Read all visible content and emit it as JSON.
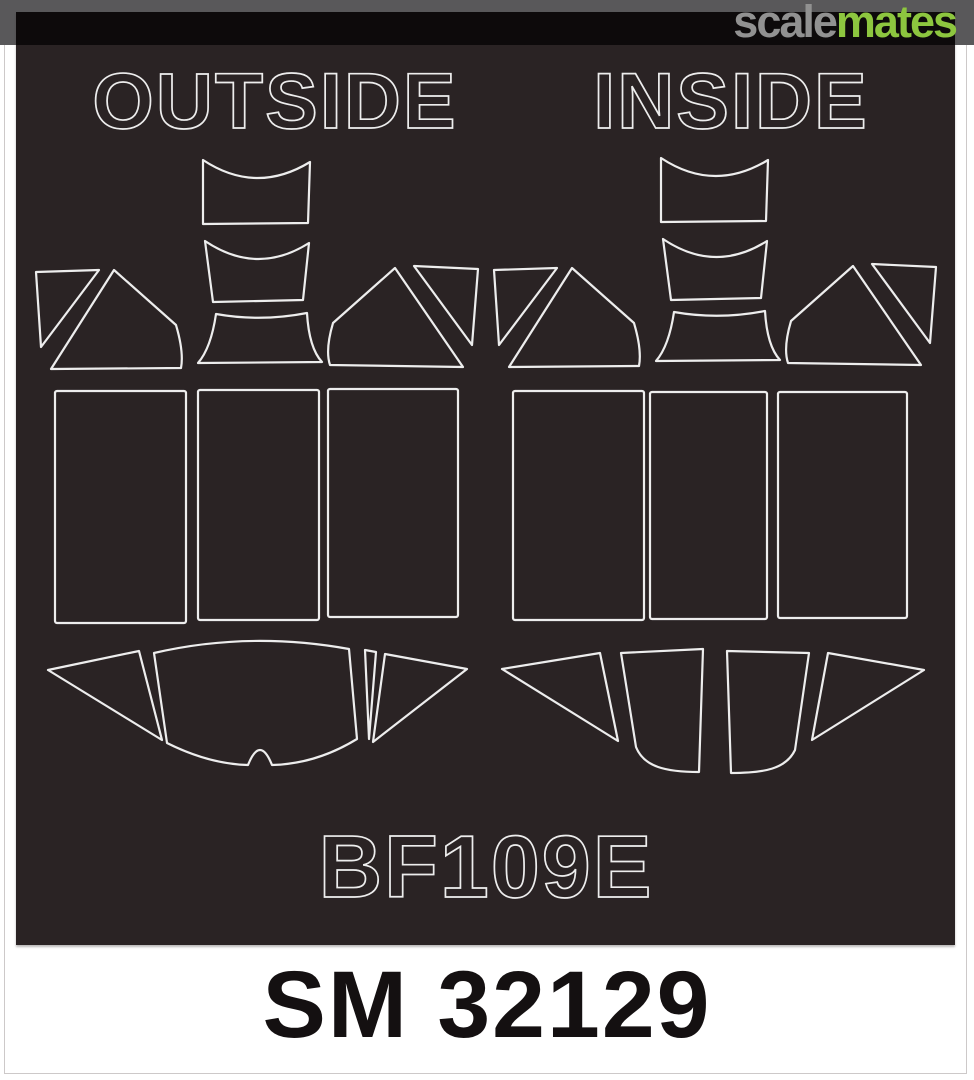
{
  "watermark": {
    "brand_first": "scale",
    "brand_second": "mates",
    "brand_first_color": "#919191",
    "brand_second_color": "#8dc63f",
    "bar_color": "#0d0a0b",
    "topbar_color": "#59585a"
  },
  "sheet": {
    "background_color": "#2a2324",
    "outline_color": "#ededed",
    "left_panel_label": "OUTSIDE",
    "right_panel_label": "INSIDE",
    "subject_label": "BF109E"
  },
  "footer": {
    "code": "SM 32129",
    "text_color": "#141011",
    "background_color": "#ffffff"
  }
}
